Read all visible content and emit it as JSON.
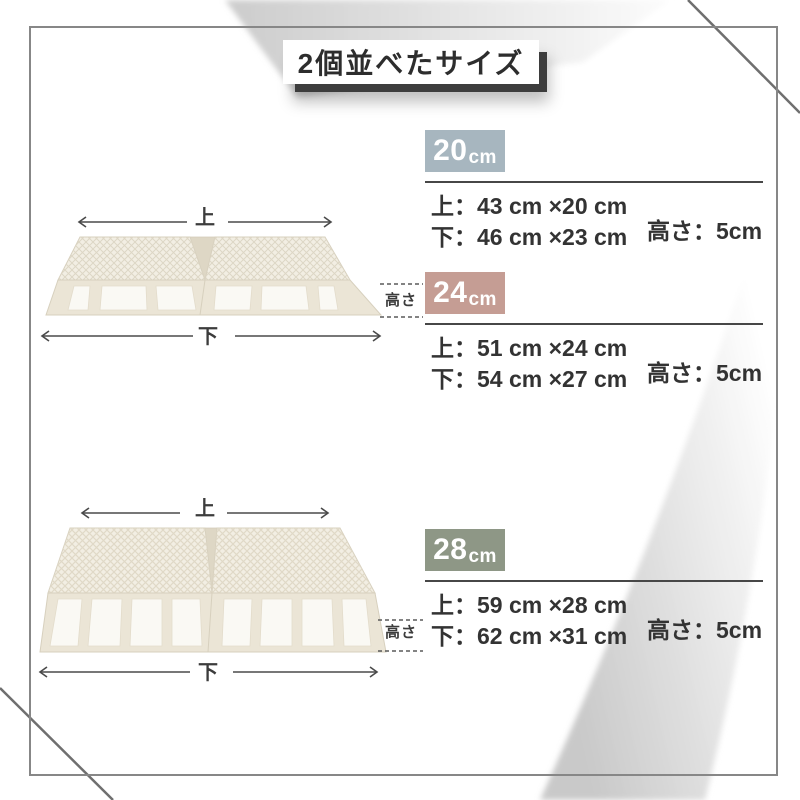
{
  "page": {
    "title": "2個並べたサイズ"
  },
  "diagram_labels": {
    "top": "上",
    "bottom": "下",
    "height": "高さ"
  },
  "sizes": [
    {
      "num": "20",
      "unit": "cm",
      "badge_color": "#a7b6bf",
      "top_dim": "上：43 cm ×20 cm",
      "bottom_dim": "下：46 cm ×23 cm",
      "height_dim": "高さ：5cm"
    },
    {
      "num": "24",
      "unit": "cm",
      "badge_color": "#c59d94",
      "top_dim": "上：51 cm ×24 cm",
      "bottom_dim": "下：54 cm ×27 cm",
      "height_dim": "高さ：5cm"
    },
    {
      "num": "28",
      "unit": "cm",
      "badge_color": "#8e9786",
      "top_dim": "上：59 cm ×28 cm",
      "bottom_dim": "下：62 cm ×31 cm",
      "height_dim": "高さ：5cm"
    }
  ],
  "colors": {
    "frame_border": "#878787",
    "divider": "#474747",
    "text": "#333333",
    "product_body": "#f2eee3",
    "title_shadow": "#3d3d3d"
  }
}
